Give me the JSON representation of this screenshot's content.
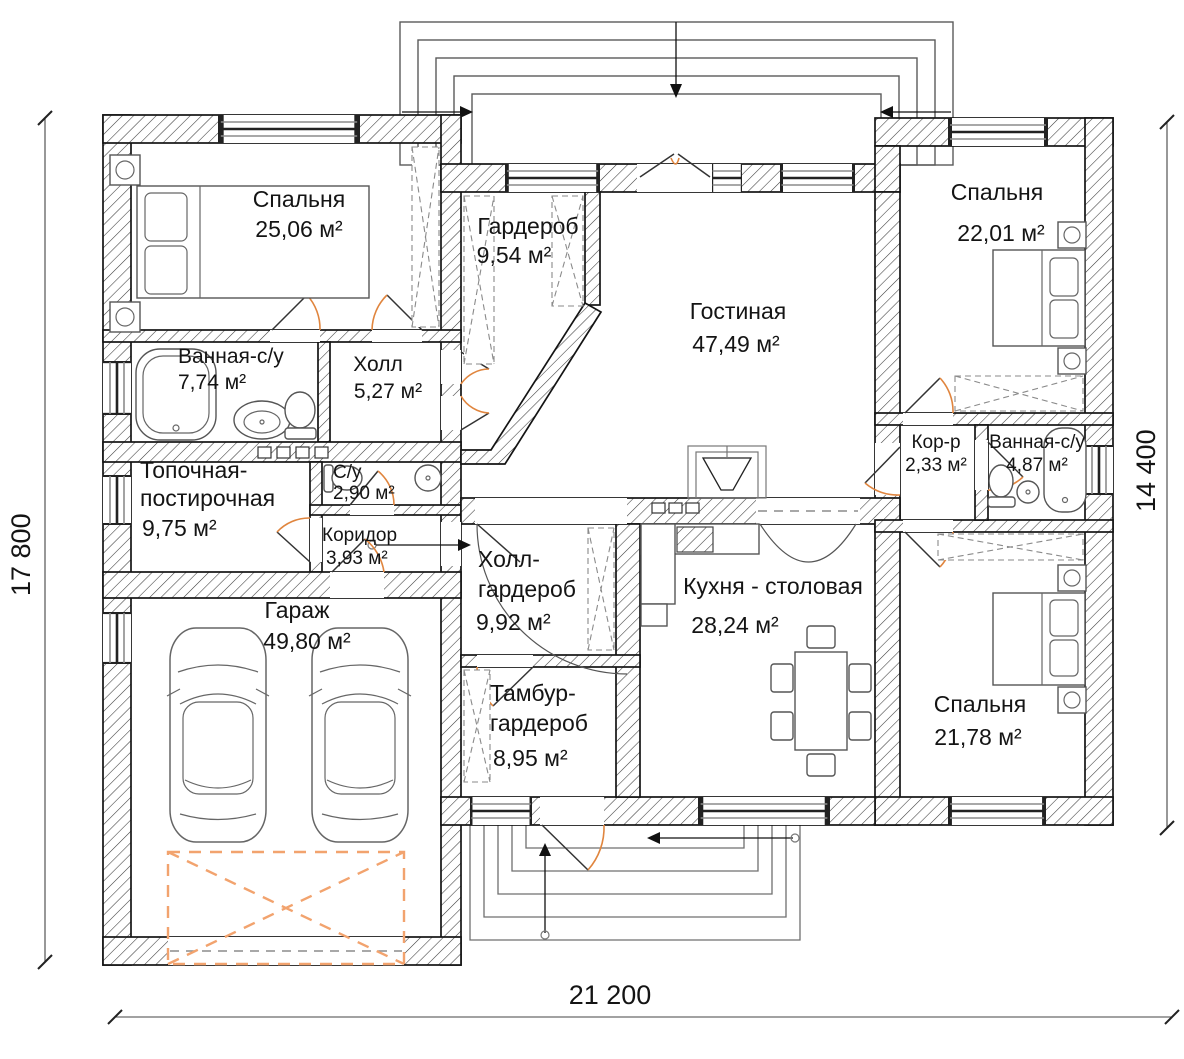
{
  "colors": {
    "door_arc": "#e0853e",
    "garage_gate": "#f2a36e"
  },
  "dimensions": {
    "left_mm": "17 800",
    "right_mm": "14 400",
    "bottom_mm": "21 200"
  },
  "rooms": [
    {
      "id": "bedroom-1",
      "name_lines": [
        "Спальня"
      ],
      "area": "25,06 м²"
    },
    {
      "id": "wardrobe",
      "name_lines": [
        "Гардероб"
      ],
      "area": "9,54 м²"
    },
    {
      "id": "living-room",
      "name_lines": [
        "Гостиная"
      ],
      "area": "47,49 м²"
    },
    {
      "id": "bedroom-2",
      "name_lines": [
        "Спальня"
      ],
      "area": "22,01 м²"
    },
    {
      "id": "bathroom-1",
      "name_lines": [
        "Ванная-с/у"
      ],
      "area": "7,74 м²"
    },
    {
      "id": "hall",
      "name_lines": [
        "Холл"
      ],
      "area": "5,27 м²"
    },
    {
      "id": "corridor-small",
      "name_lines": [
        "Кор-р"
      ],
      "area": "2,33 м²"
    },
    {
      "id": "bathroom-2",
      "name_lines": [
        "Ванная-с/у"
      ],
      "area": "4,87 м²"
    },
    {
      "id": "boiler-laundry",
      "name_lines": [
        "Топочная-",
        "постирочная"
      ],
      "area": "9,75 м²"
    },
    {
      "id": "wc",
      "name_lines": [
        "С/у"
      ],
      "area": "2,90 м²"
    },
    {
      "id": "corridor",
      "name_lines": [
        "Коридор"
      ],
      "area": "3,93 м²"
    },
    {
      "id": "hall-wardrobe",
      "name_lines": [
        "Холл-",
        "гардероб"
      ],
      "area": "9,92 м²"
    },
    {
      "id": "kitchen-dining",
      "name_lines": [
        "Кухня - столовая"
      ],
      "area": "28,24 м²"
    },
    {
      "id": "garage",
      "name_lines": [
        "Гараж"
      ],
      "area": "49,80 м²"
    },
    {
      "id": "tambour-wardrobe",
      "name_lines": [
        "Тамбур-",
        "гардероб"
      ],
      "area": "8,95 м²"
    },
    {
      "id": "bedroom-3",
      "name_lines": [
        "Спальня"
      ],
      "area": "21,78 м²"
    }
  ]
}
